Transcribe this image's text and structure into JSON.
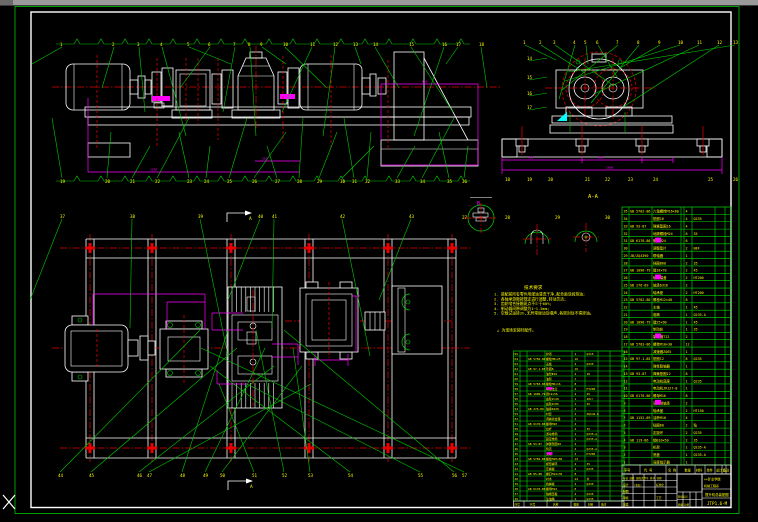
{
  "window": {
    "titlebar_color": "#9a9a9a",
    "cursor": "crosshair"
  },
  "colors": {
    "background": "#000000",
    "border_green": "#00e000",
    "geometry_white": "#ffffff",
    "centerline_red": "#e80000",
    "dimension_magenta": "#ff00ff",
    "text_yellow": "#ffff00",
    "hatch_blue": "#2b2be6",
    "wedge_cyan": "#00ffff"
  },
  "labels": {
    "section_aa": "A-A",
    "section_a": "A",
    "detail_b": "B",
    "detail_c": "C"
  },
  "dim_texts": [
    {
      "x": 528,
      "y": 158.5,
      "t": "400"
    },
    {
      "x": 598,
      "y": 158.5,
      "t": "800"
    },
    {
      "x": 606,
      "y": 168.5,
      "t": "1600"
    },
    {
      "x": 150,
      "y": 170.5,
      "t": "1250"
    },
    {
      "x": 262,
      "y": 159.5,
      "t": "320"
    },
    {
      "x": 422,
      "y": 82.5,
      "t": "650"
    }
  ],
  "balloons": {
    "rows": [
      {
        "name": "elev-top",
        "y": 44,
        "zig": [
          56,
          470
        ],
        "leader": "down",
        "labels": [
          {
            "x": 60,
            "t": "1"
          },
          {
            "x": 112,
            "t": "2"
          },
          {
            "x": 137,
            "t": "3"
          },
          {
            "x": 160,
            "t": "4"
          },
          {
            "x": 187,
            "t": "5"
          },
          {
            "x": 208,
            "t": "6"
          },
          {
            "x": 233,
            "t": "7"
          },
          {
            "x": 248,
            "t": "8"
          },
          {
            "x": 260,
            "t": "9"
          },
          {
            "x": 283,
            "t": "10"
          },
          {
            "x": 310,
            "t": "11"
          },
          {
            "x": 333,
            "t": "12"
          },
          {
            "x": 353,
            "t": "13"
          },
          {
            "x": 373,
            "t": "14"
          },
          {
            "x": 409,
            "t": "15"
          },
          {
            "x": 442,
            "t": "16"
          },
          {
            "x": 456,
            "t": "17"
          },
          {
            "x": 479,
            "t": "18"
          }
        ]
      },
      {
        "name": "elev-bottom",
        "y": 181,
        "zig": [
          56,
          470
        ],
        "leader": "up",
        "labels": [
          {
            "x": 60,
            "t": "19"
          },
          {
            "x": 105,
            "t": "20"
          },
          {
            "x": 130,
            "t": "21"
          },
          {
            "x": 155,
            "t": "22"
          },
          {
            "x": 187,
            "t": "23"
          },
          {
            "x": 204,
            "t": "24"
          },
          {
            "x": 227,
            "t": "25"
          },
          {
            "x": 252,
            "t": "26"
          },
          {
            "x": 275,
            "t": "27"
          },
          {
            "x": 297,
            "t": "28"
          },
          {
            "x": 317,
            "t": "29"
          },
          {
            "x": 340,
            "t": "30"
          },
          {
            "x": 352,
            "t": "31"
          },
          {
            "x": 365,
            "t": "32"
          },
          {
            "x": 395,
            "t": "33"
          },
          {
            "x": 420,
            "t": "34"
          },
          {
            "x": 447,
            "t": "35"
          },
          {
            "x": 462,
            "t": "36"
          }
        ]
      },
      {
        "name": "end-top",
        "y": 42,
        "leader": "end",
        "labels": [
          {
            "x": 523,
            "t": "1"
          },
          {
            "x": 539,
            "t": "2"
          },
          {
            "x": 553,
            "t": "3"
          },
          {
            "x": 573,
            "t": "4"
          },
          {
            "x": 584,
            "t": "5"
          },
          {
            "x": 596,
            "t": "6"
          },
          {
            "x": 616,
            "t": "7"
          },
          {
            "x": 637,
            "t": "8"
          },
          {
            "x": 658,
            "t": "9"
          },
          {
            "x": 678,
            "t": "10"
          },
          {
            "x": 697,
            "t": "11"
          },
          {
            "x": 717,
            "t": "12"
          },
          {
            "x": 733,
            "t": "13"
          }
        ]
      },
      {
        "name": "end-left",
        "x": 527,
        "leader": "stub",
        "labels": [
          {
            "y": 58,
            "t": "14"
          },
          {
            "y": 77,
            "t": "15"
          },
          {
            "y": 93,
            "t": "16"
          },
          {
            "y": 107,
            "t": "17"
          }
        ]
      },
      {
        "name": "end-bottom",
        "y": 179,
        "labels": [
          {
            "x": 505,
            "t": "18"
          },
          {
            "x": 527,
            "t": "19"
          },
          {
            "x": 548,
            "t": "20"
          },
          {
            "x": 585,
            "t": "21"
          },
          {
            "x": 605,
            "t": "22"
          },
          {
            "x": 628,
            "t": "23"
          },
          {
            "x": 653,
            "t": "24"
          },
          {
            "x": 708,
            "t": "25"
          },
          {
            "x": 733,
            "t": "26"
          }
        ]
      },
      {
        "name": "detail-row",
        "y": 217,
        "labels": [
          {
            "x": 462,
            "t": "27"
          },
          {
            "x": 505,
            "t": "28"
          },
          {
            "x": 555,
            "t": "29"
          },
          {
            "x": 605,
            "t": "30"
          }
        ]
      },
      {
        "name": "plan-top",
        "y": 216,
        "leader": "planDown",
        "labels": [
          {
            "x": 60,
            "t": "37"
          },
          {
            "x": 130,
            "t": "38"
          },
          {
            "x": 198,
            "t": "39"
          },
          {
            "x": 258,
            "t": "40"
          },
          {
            "x": 272,
            "t": "41"
          },
          {
            "x": 340,
            "t": "42"
          },
          {
            "x": 409,
            "t": "43"
          }
        ]
      },
      {
        "name": "plan-bottom",
        "y": 475,
        "leader": "planUp",
        "labels": [
          {
            "x": 58,
            "t": "44"
          },
          {
            "x": 89,
            "t": "45"
          },
          {
            "x": 137,
            "t": "46"
          },
          {
            "x": 147,
            "t": "47"
          },
          {
            "x": 180,
            "t": "48"
          },
          {
            "x": 203,
            "t": "49"
          },
          {
            "x": 220,
            "t": "50"
          },
          {
            "x": 252,
            "t": "51"
          },
          {
            "x": 282,
            "t": "52"
          },
          {
            "x": 308,
            "t": "53"
          },
          {
            "x": 348,
            "t": "54"
          },
          {
            "x": 418,
            "t": "55"
          },
          {
            "x": 452,
            "t": "56"
          },
          {
            "x": 462,
            "t": "57"
          }
        ]
      }
    ]
  },
  "notes": {
    "title": "技术要求",
    "x": 494,
    "y0": 295.5,
    "dy": 4.8,
    "lines": [
      "1. 装配前所有零件用煤油清洗干净,配合面涂润滑油;",
      "2. 各轴承游隙按规定进行调整,转动灵活;",
      "3. 齿轮啮合接触斑点不少于60%;",
      "4. 制动器间隙调整为1~1.5mm;",
      "5. 空载试运转2h,无异常振动及噪声,各密封处不得渗油。"
    ],
    "extra": "△ 为现场安装时配作。",
    "extra_x": 497,
    "extra_y": 331.5
  },
  "bom_right": {
    "x": 622,
    "y": 207,
    "w": 109,
    "n": 35,
    "row_h": 7.371,
    "font": 3.4,
    "cols": [
      629,
      652,
      681,
      684,
      692,
      715,
      725
    ],
    "fx": [
      623.5,
      630,
      653,
      685.5,
      693.5,
      716.5
    ],
    "magenta_rows": [
      4,
      9,
      17,
      26
    ],
    "header": {
      "y": 465,
      "h": 9,
      "cols": [
        640,
        666,
        677,
        695,
        705,
        715,
        722,
        726
      ],
      "tx": [
        624,
        644,
        668,
        684.5,
        696,
        706.5,
        716,
        722.8
      ],
      "t": [
        "序号",
        "代 号",
        "名 称",
        "数量",
        "材料",
        "单件",
        "总计",
        "备注"
      ]
    },
    "rows": [
      [
        "35",
        "GB 5782-86",
        "六角螺栓M16×60",
        "4",
        ""
      ],
      [
        "34",
        "",
        "垫圈16",
        "4",
        "Q235"
      ],
      [
        "33",
        "GB 93-87",
        "弹簧垫圈16",
        "4",
        ""
      ],
      [
        "32",
        "",
        "地脚螺栓M24",
        "6",
        "35"
      ],
      [
        "31",
        "GB 6170-86",
        "螺母M24",
        "6",
        ""
      ],
      [
        "30",
        "",
        "调整垫片",
        "2",
        "08F"
      ],
      [
        "29",
        "JB/ZQ4390",
        "联轴器",
        "1",
        ""
      ],
      [
        "28",
        "",
        "挡圈B60",
        "2",
        "35"
      ],
      [
        "27",
        "GB 1096-79",
        "键18×70",
        "2",
        "45"
      ],
      [
        "26",
        "",
        "轴承端盖",
        "2",
        "HT200"
      ],
      [
        "25",
        "GB 276-89",
        "轴承6316",
        "2",
        ""
      ],
      [
        "24",
        "",
        "轴承座",
        "2",
        "HT200"
      ],
      [
        "23",
        "GB 5782-86",
        "螺栓M12×40",
        "8",
        ""
      ],
      [
        "22",
        "",
        "主轴",
        "1",
        "45"
      ],
      [
        "21",
        "",
        "卷筒",
        "1",
        "Q235-A"
      ],
      [
        "20",
        "GB 1096-79",
        "键25×90",
        "1",
        "45"
      ],
      [
        "19",
        "",
        "制动轮",
        "1",
        "35"
      ],
      [
        "18",
        "",
        "制动器TJ2",
        "2",
        ""
      ],
      [
        "17",
        "GB 5783-86",
        "螺栓M10×30",
        "12",
        ""
      ],
      [
        "16",
        "",
        "减速器ZQ65",
        "1",
        ""
      ],
      [
        "15",
        "GB 97.1-85",
        "垫圈12",
        "8",
        "Q235"
      ],
      [
        "14",
        "",
        "弹性联轴器",
        "1",
        ""
      ],
      [
        "13",
        "GB 93-87",
        "弹簧垫圈12",
        "8",
        ""
      ],
      [
        "12",
        "",
        "电动机底座",
        "1",
        "Q235"
      ],
      [
        "11",
        "",
        "电动机JR127-8",
        "1",
        ""
      ],
      [
        "10",
        "GB 6170-86",
        "螺母M16",
        "8",
        ""
      ],
      [
        "9",
        "",
        "深沟球轴承",
        "2",
        ""
      ],
      [
        "8",
        "",
        "轴承盖",
        "2",
        "HT150"
      ],
      [
        "7",
        "GB 1152-89",
        "油杯M10",
        "4",
        ""
      ],
      [
        "6",
        "",
        "毡圈60",
        "2",
        "毡"
      ],
      [
        "5",
        "",
        "定距环",
        "2",
        "Q235"
      ],
      [
        "4",
        "GB 119-86",
        "销B10×50",
        "2",
        "35"
      ],
      [
        "3",
        "",
        "机架",
        "1",
        "Q235-A"
      ],
      [
        "2",
        "",
        "底盘",
        "1",
        "Q235-A"
      ],
      [
        "1",
        "",
        "深度指示器",
        "1",
        ""
      ]
    ]
  },
  "bom_left": {
    "x": 513.5,
    "y": 351,
    "w": 110.5,
    "n": 30,
    "row_h": 5.0,
    "font": 2.9,
    "cols": [
      520,
      527,
      545,
      572,
      585,
      598,
      610
    ],
    "fx": [
      514.5,
      528,
      546,
      574.5,
      586.5
    ],
    "magenta_rows": [
      7,
      20
    ],
    "header": {
      "y": 501,
      "h": 6,
      "cols": [
        524,
        547,
        571,
        585,
        599
      ],
      "tx": [
        514.5,
        530,
        553,
        573.5,
        588,
        601
      ],
      "t": [
        "序号",
        "代号",
        "名称",
        "数量",
        "材料",
        "备注"
      ]
    },
    "rows": [
      [
        "65",
        "",
        "护罩",
        "1",
        "Q215"
      ],
      [
        "64",
        "GB 5782-86",
        "螺栓M8×25",
        "16",
        ""
      ],
      [
        "63",
        "",
        "盖板",
        "2",
        "Q235"
      ],
      [
        "62",
        "GB 97.1-85",
        "垫圈8",
        "16",
        ""
      ],
      [
        "61",
        "",
        "油管Φ10",
        "2",
        "10"
      ],
      [
        "60",
        "",
        "油泵",
        "1",
        ""
      ],
      [
        "59",
        "GB 5783-86",
        "螺栓M6×16",
        "8",
        ""
      ],
      [
        "58",
        "",
        "联接法兰",
        "2",
        "HT200"
      ],
      [
        "57",
        "GB 1096-79",
        "键12×56",
        "2",
        "45"
      ],
      [
        "56",
        "",
        "齿轮Z=20",
        "1",
        "40Cr"
      ],
      [
        "55",
        "",
        "齿轮Z=85",
        "1",
        "45"
      ],
      [
        "54",
        "GB 276-89",
        "轴承6220",
        "2",
        ""
      ],
      [
        "53",
        "",
        "衬套",
        "2",
        "ZQSn6-6"
      ],
      [
        "52",
        "",
        "调绳离合器",
        "1",
        ""
      ],
      [
        "51",
        "GB 6170-86",
        "螺母M20",
        "4",
        ""
      ],
      [
        "50",
        "",
        "拉杆",
        "2",
        "35"
      ],
      [
        "49",
        "",
        "游动卷筒",
        "1",
        "Q235-A"
      ],
      [
        "48",
        "",
        "固定卷筒",
        "1",
        "Q235-A"
      ],
      [
        "47",
        "GB 93-87",
        "弹簧垫圈20",
        "4",
        ""
      ],
      [
        "46",
        "",
        "筒壳",
        "2",
        "Q235-A"
      ],
      [
        "45",
        "",
        "支轮",
        "4",
        "HT200"
      ],
      [
        "44",
        "GB 5782-86",
        "螺栓M20×80",
        "12",
        ""
      ],
      [
        "43",
        "",
        "楔形绳环",
        "2",
        "35"
      ],
      [
        "42",
        "",
        "压绳板",
        "4",
        "Q235"
      ],
      [
        "41",
        "GB 85-88",
        "螺钉M12×30",
        "8",
        ""
      ],
      [
        "40",
        "",
        "衬木",
        "24",
        "木"
      ],
      [
        "39",
        "",
        "挡绳板",
        "2",
        "Q235"
      ],
      [
        "38",
        "GB 6170-86",
        "螺母M12",
        "8",
        ""
      ],
      [
        "37",
        "",
        "轴端压板",
        "2",
        "Q235"
      ],
      [
        "36",
        "",
        "注油嘴",
        "4",
        "Q235"
      ]
    ]
  },
  "title_block": {
    "cells": [
      {
        "x": 623,
        "y": 479,
        "t": "标记 处数 更改文件号 签字 日期",
        "s": 2.5
      },
      {
        "x": 623,
        "y": 486,
        "t": "设计",
        "s": 2.8
      },
      {
        "x": 634,
        "y": 486,
        "t": "(签名)",
        "s": 2.4
      },
      {
        "x": 656,
        "y": 486,
        "t": "标准化",
        "s": 2.6
      },
      {
        "x": 623,
        "y": 492.5,
        "t": "制图",
        "s": 2.8
      },
      {
        "x": 623,
        "y": 499,
        "t": "审核",
        "s": 2.8
      },
      {
        "x": 656,
        "y": 499,
        "t": "工艺",
        "s": 2.8
      },
      {
        "x": 623,
        "y": 505.5,
        "t": "批准",
        "s": 2.8
      },
      {
        "x": 678,
        "y": 497.5,
        "t": "阶段标记",
        "s": 2.4
      },
      {
        "x": 678,
        "y": 505.5,
        "t": "质量  比例",
        "s": 2.4
      },
      {
        "x": 704,
        "y": 480.5,
        "t": "××矿业学院",
        "s": 3.2
      },
      {
        "x": 704,
        "y": 487,
        "t": "机械工程系",
        "s": 3.0
      },
      {
        "x": 705,
        "y": 496,
        "t": "提升机总装配图",
        "s": 3.4
      },
      {
        "x": 707,
        "y": 505,
        "t": "JTP1.6-M",
        "s": 4.2
      }
    ]
  }
}
